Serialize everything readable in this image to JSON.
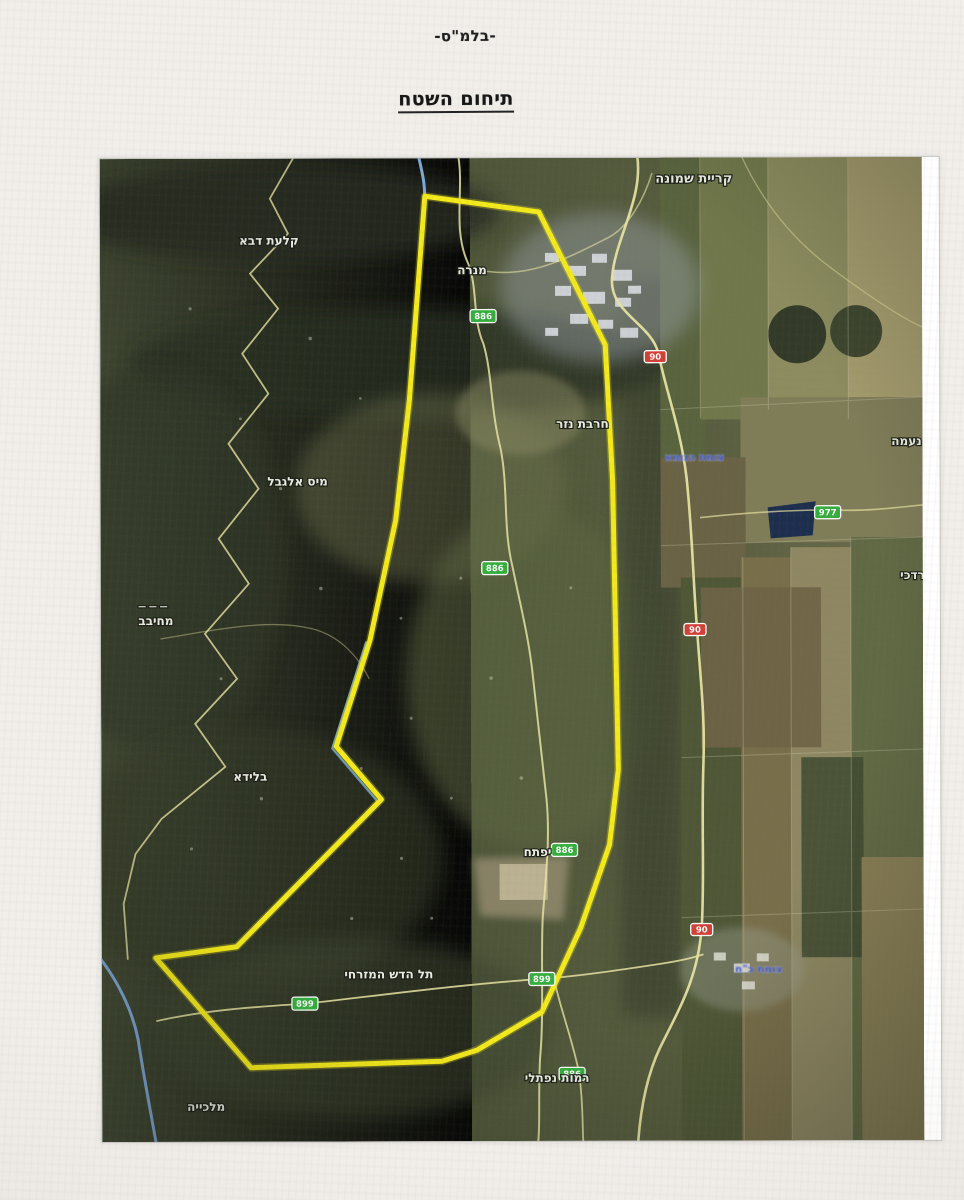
{
  "page": {
    "fragment_mark": "2",
    "classification": "-בלמ\"ס-",
    "title": "תיחום השטח"
  },
  "map": {
    "description_labels_language": "he",
    "boundary": {
      "color": "#f5eb16",
      "points": "325,38 439,54 505,187 512,322 517,612 508,687 479,770 440,854 375,892 340,903 149,909 54,799 135,788 280,641 235,588 269,482 295,362 309,242"
    },
    "place_labels": [
      {
        "id": "kiryat-shmona",
        "text": "קריית שמונה",
        "x": 594,
        "y": 25,
        "size": 13
      },
      {
        "id": "qalat-daba",
        "text": "קלעת דבא",
        "x": 169,
        "y": 86,
        "size": 12
      },
      {
        "id": "manara",
        "text": "מנרה",
        "x": 372,
        "y": 116,
        "size": 12
      },
      {
        "id": "meis-al-jabal",
        "text": "מיס אלגבל",
        "x": 197,
        "y": 327,
        "size": 12
      },
      {
        "id": "border-dashes",
        "text": "— — —",
        "x": 52,
        "y": 450,
        "size": 8
      },
      {
        "id": "mhaibib",
        "text": "מחיבב",
        "x": 55,
        "y": 466,
        "size": 12
      },
      {
        "id": "khirbet-nazar",
        "text": "חרבת נזר",
        "x": 482,
        "y": 270,
        "size": 12
      },
      {
        "id": "blida",
        "text": "בלידא",
        "x": 149,
        "y": 622,
        "size": 12
      },
      {
        "id": "yiftach",
        "text": "יפתח",
        "x": 436,
        "y": 698,
        "size": 12
      },
      {
        "id": "tel-hadash-east",
        "text": "תל הדש המזרחי",
        "x": 287,
        "y": 820,
        "size": 12
      },
      {
        "id": "malkia",
        "text": "מלכייה",
        "x": 104,
        "y": 952,
        "size": 12
      },
      {
        "id": "ramot-naftali",
        "text": "רמות נפתלי",
        "x": 455,
        "y": 924,
        "size": 12
      },
      {
        "id": "naama",
        "text": "נעמה",
        "x": 806,
        "y": 288,
        "size": 12
      },
      {
        "id": "mordechai",
        "text": "מרדכי",
        "x": 816,
        "y": 422,
        "size": 12
      }
    ],
    "poi_labels": [
      {
        "id": "junction-north",
        "text": "צומת הגומא",
        "x": 594,
        "y": 303
      },
      {
        "id": "junction-koach",
        "text": "צומת כ\"ח",
        "x": 657,
        "y": 815
      }
    ],
    "road_shields": [
      {
        "type": "green",
        "number": "886",
        "x": 383,
        "y": 158
      },
      {
        "type": "green",
        "number": "886",
        "x": 394,
        "y": 410
      },
      {
        "type": "green",
        "number": "886",
        "x": 463,
        "y": 692
      },
      {
        "type": "green",
        "number": "899",
        "x": 203,
        "y": 845
      },
      {
        "type": "green",
        "number": "899",
        "x": 440,
        "y": 821
      },
      {
        "type": "green",
        "number": "886",
        "x": 470,
        "y": 916
      },
      {
        "type": "green",
        "number": "977",
        "x": 727,
        "y": 355
      },
      {
        "type": "red",
        "number": "90",
        "x": 555,
        "y": 199
      },
      {
        "type": "red",
        "number": "90",
        "x": 594,
        "y": 472
      },
      {
        "type": "red",
        "number": "90",
        "x": 600,
        "y": 772
      }
    ],
    "colors": {
      "boundary_yellow": "#f5eb16",
      "shield_green": "#2fae3a",
      "shield_red": "#d23c32",
      "river_blue": "#7ba7d9",
      "place_label_white": "#f4f4ec",
      "poi_label_blue": "#2743d0"
    }
  }
}
